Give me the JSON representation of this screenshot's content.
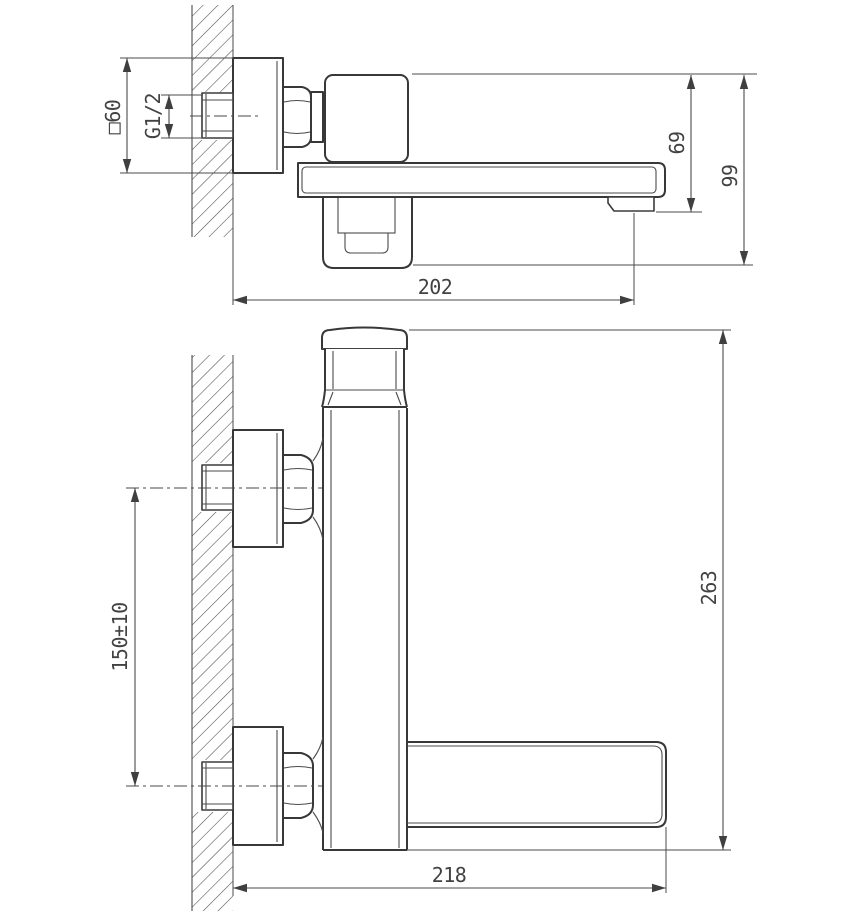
{
  "drawing": {
    "side_view": {
      "flange_size_label": "□60",
      "thread_label": "G1/2",
      "spout_drop_label": "69",
      "body_drop_label": "99",
      "spout_reach_label": "202"
    },
    "front_view": {
      "inlet_spacing_label": "150±10",
      "total_height_label": "263",
      "total_reach_label": "218"
    }
  }
}
